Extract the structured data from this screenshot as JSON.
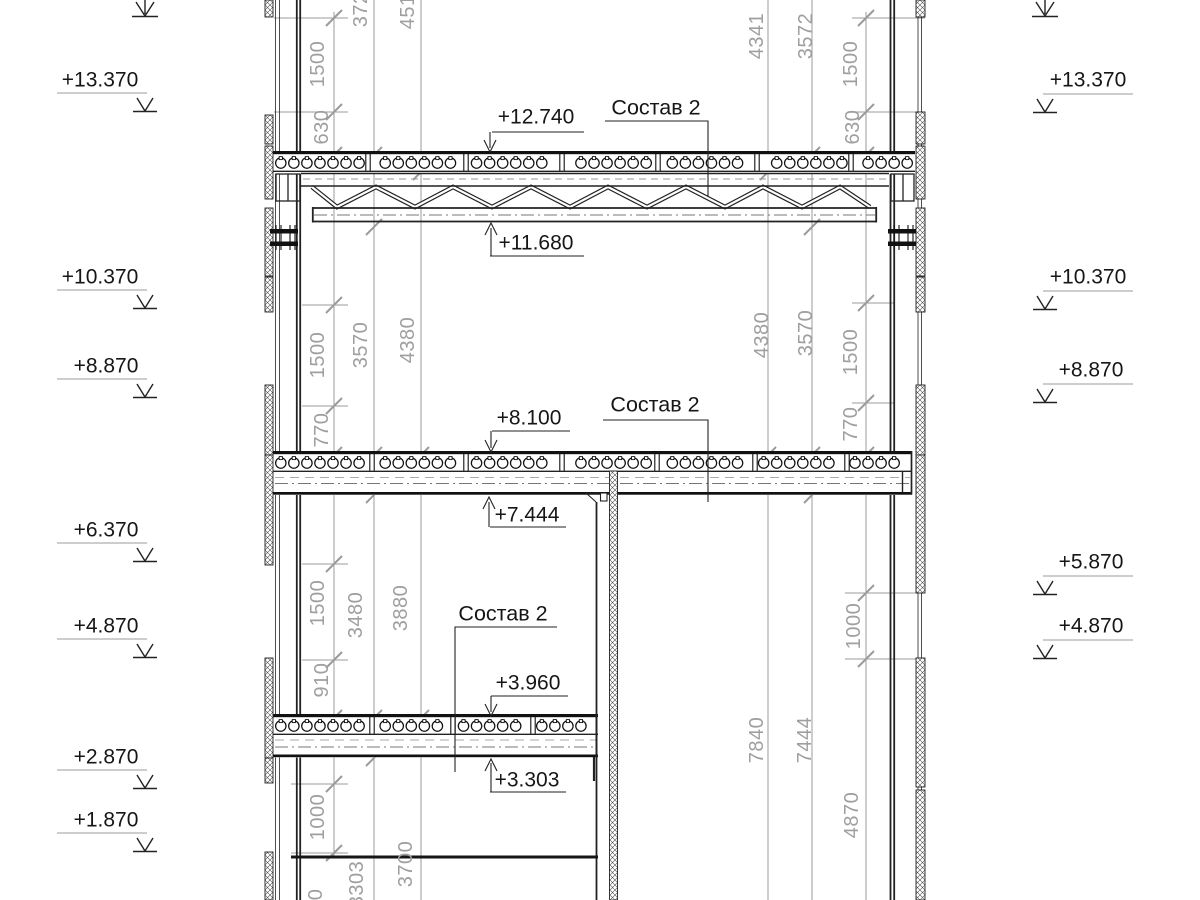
{
  "composition_label": "Состав 2",
  "elevations_left": [
    "+13.370",
    "+10.370",
    "+8.870",
    "+6.370",
    "+4.870",
    "+2.870",
    "+1.870"
  ],
  "elevations_right": [
    "+13.370",
    "+10.370",
    "+8.870",
    "+5.870",
    "+4.870"
  ],
  "levels": [
    "+12.740",
    "+11.680",
    "+8.100",
    "+7.444",
    "+3.960",
    "+3.303"
  ],
  "dims_left": [
    "1500",
    "630",
    "3725",
    "4516",
    "1500",
    "770",
    "3570",
    "4380",
    "1500",
    "910",
    "3480",
    "3880",
    "1000",
    "970",
    "3303",
    "3700"
  ],
  "dims_right": [
    "4341",
    "3572",
    "1500",
    "630",
    "4380",
    "3570",
    "1500",
    "770",
    "1000",
    "7840",
    "7444",
    "4870"
  ]
}
